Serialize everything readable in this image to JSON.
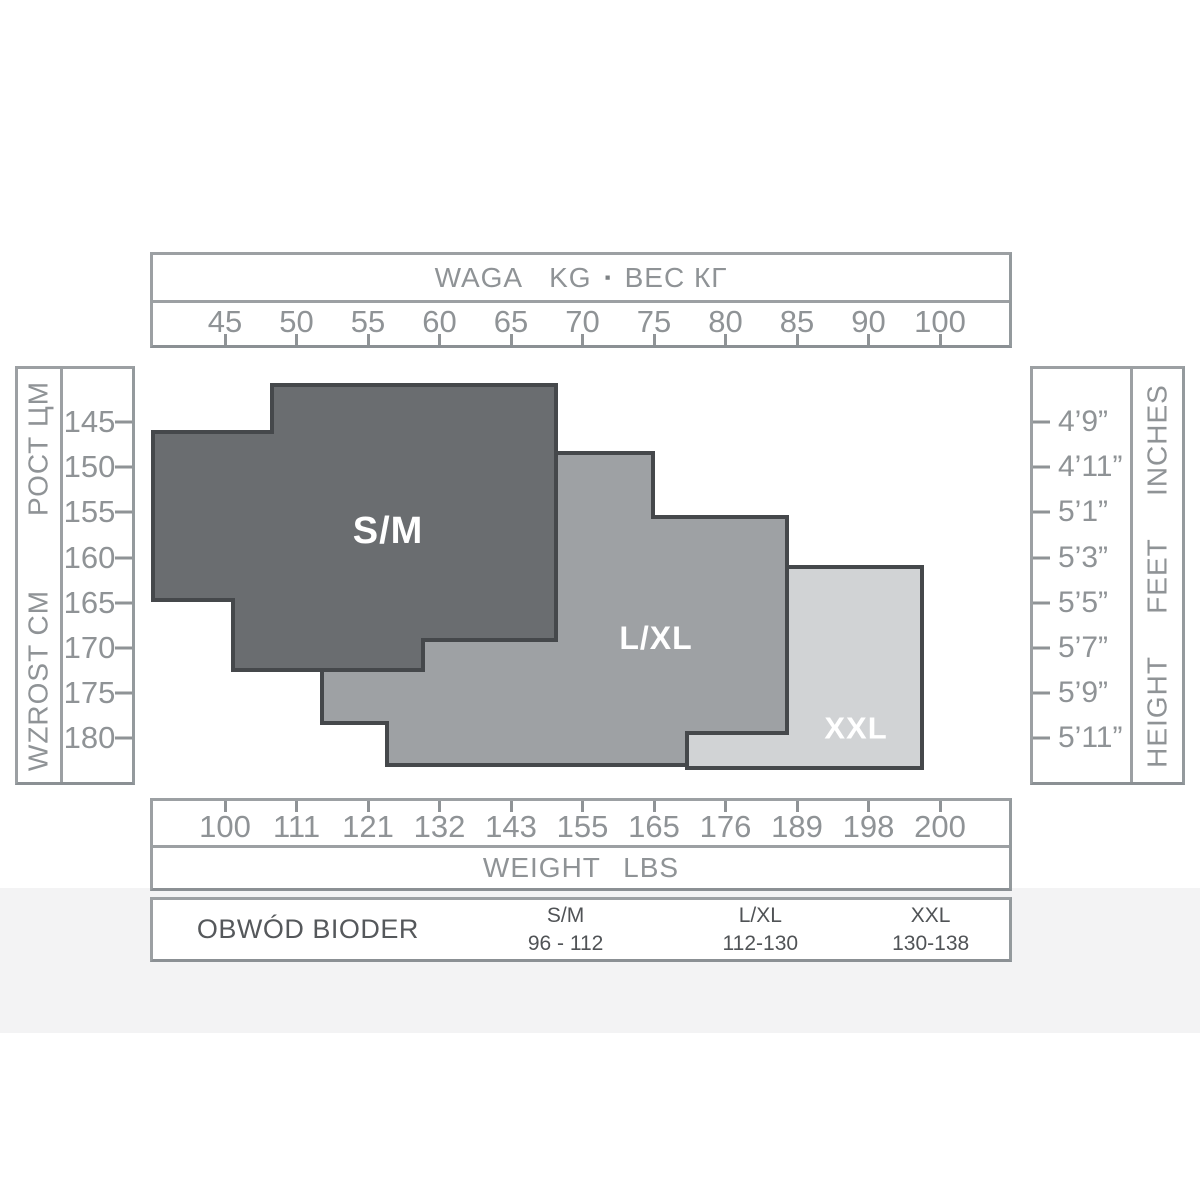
{
  "top_axis": {
    "title": {
      "w1": "WAGA",
      "w2": "KG",
      "bullet": "▪",
      "w3": "ВЕС КГ"
    },
    "ticks": [
      "45",
      "50",
      "55",
      "60",
      "65",
      "70",
      "75",
      "80",
      "85",
      "90",
      "100"
    ]
  },
  "bottom_axis": {
    "ticks": [
      "100",
      "111",
      "121",
      "132",
      "143",
      "155",
      "165",
      "176",
      "189",
      "198",
      "200"
    ],
    "title": "WEIGHT LBS"
  },
  "left_axis": {
    "label_primary": "WZROST CM",
    "label_secondary": "РОСТ ЦМ",
    "ticks": [
      "145",
      "150",
      "155",
      "160",
      "165",
      "170",
      "175",
      "180"
    ]
  },
  "right_axis": {
    "label": "HEIGHT FEET INCHES",
    "ticks": [
      "4’9”",
      "4’11”",
      "5’1”",
      "5’3”",
      "5’5”",
      "5’7”",
      "5’9”",
      "5’11”"
    ]
  },
  "table": {
    "row_label": "OBWÓD BIODER",
    "columns": [
      {
        "size": "S/M",
        "range": "96 - 112"
      },
      {
        "size": "L/XL",
        "range": "112-130"
      },
      {
        "size": "XXL",
        "range": "130-138"
      }
    ]
  },
  "chart_data": {
    "type": "area",
    "description": "Hosiery size chart: stepped size regions plotted against body weight (kg top axis / lbs bottom axis) and height (cm left axis / feet-inches right axis).",
    "x_axis": {
      "top_ticks_kg": [
        45,
        50,
        55,
        60,
        65,
        70,
        75,
        80,
        85,
        90,
        100
      ],
      "bottom_ticks_lbs": [
        100,
        111,
        121,
        132,
        143,
        155,
        165,
        176,
        189,
        198,
        200
      ]
    },
    "y_axis": {
      "left_ticks_cm": [
        145,
        150,
        155,
        160,
        165,
        170,
        175,
        180
      ],
      "right_ticks_ft_in": [
        "4’9”",
        "4’11”",
        "5’1”",
        "5’3”",
        "5’5”",
        "5’7”",
        "5’9”",
        "5’11”"
      ]
    },
    "stroke": "#45484b",
    "stroke_width": 4,
    "label_color": "#ffffff",
    "regions": [
      {
        "name": "XXL",
        "fill": "#d1d3d5",
        "approx_kg_range": [
          77,
          94
        ],
        "approx_cm_range": [
          161,
          183
        ],
        "hips_cm": "130-138",
        "label": {
          "text": "XXL",
          "x": 856,
          "y": 728,
          "size": 31
        },
        "polygon_px": [
          [
            785,
            567
          ],
          [
            922,
            567
          ],
          [
            922,
            768
          ],
          [
            687,
            768
          ],
          [
            687,
            733
          ],
          [
            785,
            733
          ]
        ]
      },
      {
        "name": "L/XL",
        "fill": "#9ea1a4",
        "approx_kg_range": [
          52,
          84
        ],
        "approx_cm_range": [
          148,
          183
        ],
        "hips_cm": "112-130",
        "label": {
          "text": "L/XL",
          "x": 656,
          "y": 638,
          "size": 32
        },
        "polygon_px": [
          [
            322,
            612
          ],
          [
            556,
            612
          ],
          [
            556,
            453
          ],
          [
            653,
            453
          ],
          [
            653,
            517
          ],
          [
            787,
            517
          ],
          [
            787,
            733
          ],
          [
            687,
            733
          ],
          [
            687,
            765
          ],
          [
            387,
            765
          ],
          [
            387,
            723
          ],
          [
            322,
            723
          ]
        ]
      },
      {
        "name": "S/M",
        "fill": "#6a6d70",
        "approx_kg_range": [
          40,
          68
        ],
        "approx_cm_range": [
          141,
          172
        ],
        "hips_cm": "96-112",
        "label": {
          "text": "S/M",
          "x": 388,
          "y": 531,
          "size": 38
        },
        "polygon_px": [
          [
            272,
            385
          ],
          [
            556,
            385
          ],
          [
            556,
            640
          ],
          [
            423,
            640
          ],
          [
            423,
            670
          ],
          [
            233,
            670
          ],
          [
            233,
            600
          ],
          [
            153,
            600
          ],
          [
            153,
            432
          ],
          [
            272,
            432
          ]
        ]
      }
    ],
    "layout": {
      "canvas": [
        1200,
        1200
      ],
      "top_scale": {
        "first": 72,
        "spacing": 71.5
      },
      "bottom_scale": {
        "first": 72,
        "spacing": 71.5
      },
      "left_scale": {
        "first": 53,
        "spacing": 45.2
      },
      "right_scale": {
        "first": 53,
        "spacing": 45.2
      },
      "grid": false,
      "legend": "region labels inline"
    }
  }
}
